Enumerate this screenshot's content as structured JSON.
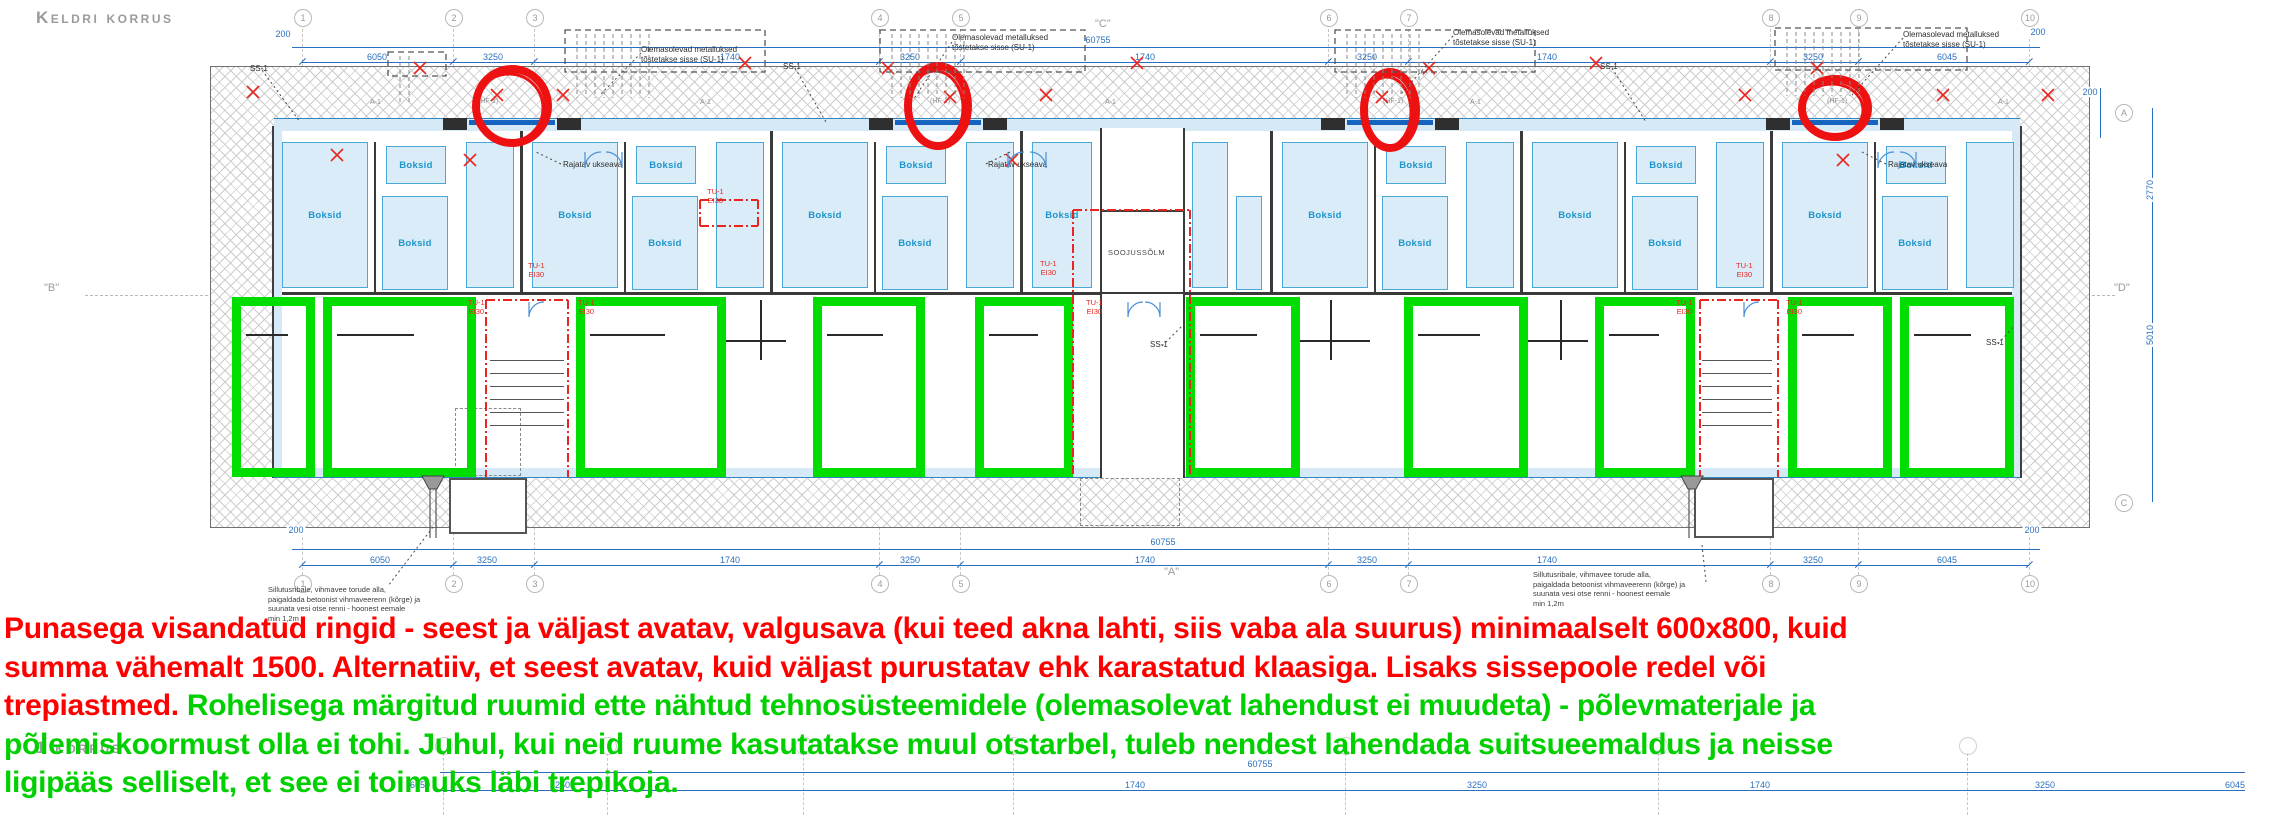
{
  "title": "Keldri korrus",
  "floor1_title": "1 korrus",
  "colors": {
    "red": "#ff0000",
    "green": "#00cf00",
    "dim_blue": "#2a6fc0",
    "boksid_fill": "#d9ecf7",
    "boksid_stroke": "#49a8d8",
    "boksid_text": "#1e95cc",
    "green_room": "#00dd00",
    "fire_red": "#e8251f",
    "wall": "#3a3a3a",
    "muted": "#9b9b9b"
  },
  "legend": {
    "lines": [
      {
        "segs": [
          {
            "c": "#ff0000",
            "t": "Punasega visandatud ringid - seest ja väljast avatav, valgusava (kui teed akna lahti, siis vaba ala suurus) minimaalselt 600x800, kuid"
          }
        ]
      },
      {
        "segs": [
          {
            "c": "#ff0000",
            "t": "summa vähemalt 1500. Alternatiiv, et seest avatav, kuid väljast purustatav ehk karastatud klaasiga. Lisaks sissepoole redel või"
          }
        ]
      },
      {
        "segs": [
          {
            "c": "#ff0000",
            "t": "trepiastmed. "
          },
          {
            "c": "#00cf00",
            "t": "Rohelisega märgitud ruumid ette nähtud tehnosüsteemidele (olemasolevat lahendust ei muudeta) - põlevmaterjale ja"
          }
        ]
      },
      {
        "segs": [
          {
            "c": "#00cf00",
            "t": "põlemiskoormust olla ei tohi. Juhul, kui neid ruume kasutatakse muul otstarbel, tuleb nendest lahendada suitsueemaldus ja neisse"
          }
        ]
      },
      {
        "segs": [
          {
            "c": "#00cf00",
            "t": "ligipääs selliselt, et see ei toimuks läbi trepikoja."
          }
        ]
      }
    ]
  },
  "plan": {
    "grid_numbers": [
      "1",
      "2",
      "3",
      "4",
      "5",
      "6",
      "7",
      "8",
      "9",
      "10"
    ],
    "grid_x": [
      302,
      453,
      534,
      879,
      960,
      1328,
      1408,
      1770,
      1858,
      2029
    ],
    "side_bubbles": [
      {
        "t": "A",
        "x": 2123,
        "y": 112
      },
      {
        "t": "C",
        "x": 2123,
        "y": 502
      }
    ],
    "section_markers": [
      {
        "t": "\"C\"",
        "x": 1095,
        "y": 18
      },
      {
        "t": "\"A\"",
        "x": 1164,
        "y": 566
      },
      {
        "t": "\"B\"",
        "x": 44,
        "y": 282
      },
      {
        "t": "\"D\"",
        "x": 2114,
        "y": 282
      }
    ],
    "dims": {
      "top_total": {
        "v": "60755",
        "x": 1098,
        "y": 40
      },
      "top_total_y": 47,
      "top_row_y": 62,
      "top": [
        [
          "6050",
          377
        ],
        [
          "3250",
          493
        ],
        [
          "1740",
          730
        ],
        [
          "3250",
          910
        ],
        [
          "1740",
          1145
        ],
        [
          "3250",
          1367
        ],
        [
          "1740",
          1547
        ],
        [
          "3250",
          1813
        ],
        [
          "6045",
          1947
        ]
      ],
      "top_200": [
        {
          "v": "200",
          "x": 283,
          "y": 34
        },
        {
          "v": "200",
          "x": 2038,
          "y": 32
        }
      ],
      "bottom_total": {
        "v": "60755",
        "x": 1163,
        "y": 542
      },
      "bottom_total_y": 549,
      "bottom_row_y": 565,
      "bottom": [
        [
          "6050",
          380
        ],
        [
          "3250",
          487
        ],
        [
          "1740",
          730
        ],
        [
          "3250",
          910
        ],
        [
          "1740",
          1145
        ],
        [
          "3250",
          1367
        ],
        [
          "1740",
          1547
        ],
        [
          "3250",
          1813
        ],
        [
          "6045",
          1947
        ]
      ],
      "bottom_200": [
        {
          "v": "200",
          "x": 296,
          "y": 530
        },
        {
          "v": "200",
          "x": 2032,
          "y": 530
        }
      ],
      "right": [
        {
          "v": "200",
          "x": 2090,
          "y": 92,
          "rot": 0
        },
        {
          "v": "2770",
          "x": 2150,
          "y": 190,
          "rot": 1
        },
        {
          "v": "5010",
          "x": 2150,
          "y": 335,
          "rot": 1
        }
      ]
    },
    "labels": {
      "boksid": "Boksid",
      "soojussolm": "SOOJUSSÕLM",
      "ss1": "SS-1",
      "su1_line1": "Olemasolevad metalluksed",
      "su1_line2": "tõstetakse sisse (SU-1)",
      "rajatav": "Rajatav ukseava",
      "fire1": "TU-1",
      "fire2": "EI30",
      "a1": "A-1",
      "hf1": "(HF-1)",
      "drain_note": [
        "Sillutusribale, vihmavee torude alla,",
        "paigaldada betoonist vihmaveerenn (kõrge) ja",
        "suunata vesi otse renni - hoonest eemale",
        "min 1,2m"
      ]
    },
    "ss1_pos": [
      [
        250,
        64
      ],
      [
        783,
        62
      ],
      [
        1600,
        62
      ],
      [
        1150,
        340
      ],
      [
        1986,
        338
      ]
    ],
    "su1_pos": [
      [
        641,
        45
      ],
      [
        952,
        33
      ],
      [
        1453,
        28
      ],
      [
        1903,
        30
      ]
    ],
    "rajatav_pos": [
      [
        563,
        160
      ],
      [
        988,
        160
      ],
      [
        1888,
        160
      ]
    ],
    "a1_pos": [
      [
        370,
        99
      ],
      [
        700,
        99
      ],
      [
        1105,
        99
      ],
      [
        1470,
        99
      ],
      [
        1998,
        99
      ]
    ],
    "hf1_pos": [
      [
        478,
        98
      ],
      [
        930,
        98
      ],
      [
        1383,
        98
      ],
      [
        1827,
        98
      ]
    ],
    "fire_pos": [
      [
        528,
        262
      ],
      [
        468,
        299
      ],
      [
        578,
        299
      ],
      [
        1040,
        260
      ],
      [
        1086,
        299
      ],
      [
        1736,
        262
      ],
      [
        1676,
        299
      ],
      [
        1786,
        299
      ],
      [
        707,
        188
      ]
    ],
    "drain_note_pos": [
      [
        268,
        585
      ],
      [
        1533,
        570
      ]
    ],
    "boksid_boxes": [
      [
        282,
        142,
        86,
        146,
        1
      ],
      [
        386,
        146,
        60,
        38,
        1
      ],
      [
        382,
        196,
        66,
        94,
        1
      ],
      [
        466,
        142,
        48,
        146,
        0
      ],
      [
        532,
        142,
        86,
        146,
        1
      ],
      [
        636,
        146,
        60,
        38,
        1
      ],
      [
        632,
        196,
        66,
        94,
        1
      ],
      [
        716,
        142,
        48,
        146,
        0
      ],
      [
        782,
        142,
        86,
        146,
        1
      ],
      [
        886,
        146,
        60,
        38,
        1
      ],
      [
        882,
        196,
        66,
        94,
        1
      ],
      [
        966,
        142,
        48,
        146,
        0
      ],
      [
        1032,
        142,
        60,
        146,
        1
      ],
      [
        1192,
        142,
        36,
        146,
        0
      ],
      [
        1236,
        196,
        26,
        94,
        0
      ],
      [
        1282,
        142,
        86,
        146,
        1
      ],
      [
        1386,
        146,
        60,
        38,
        1
      ],
      [
        1382,
        196,
        66,
        94,
        1
      ],
      [
        1466,
        142,
        48,
        146,
        0
      ],
      [
        1532,
        142,
        86,
        146,
        1
      ],
      [
        1636,
        146,
        60,
        38,
        1
      ],
      [
        1632,
        196,
        66,
        94,
        1
      ],
      [
        1716,
        142,
        48,
        146,
        0
      ],
      [
        1782,
        142,
        86,
        146,
        1
      ],
      [
        1886,
        146,
        60,
        38,
        1
      ],
      [
        1882,
        196,
        66,
        94,
        1
      ],
      [
        1966,
        142,
        48,
        146,
        0
      ]
    ],
    "green_rooms": [
      [
        232,
        297,
        83,
        180
      ],
      [
        323,
        297,
        153,
        180
      ],
      [
        576,
        297,
        150,
        180
      ],
      [
        813,
        297,
        112,
        180
      ],
      [
        975,
        297,
        98,
        180
      ],
      [
        1186,
        297,
        114,
        180
      ],
      [
        1404,
        297,
        124,
        180
      ],
      [
        1595,
        297,
        100,
        180
      ],
      [
        1788,
        297,
        104,
        180
      ],
      [
        1900,
        297,
        114,
        180
      ]
    ],
    "stairs": [
      {
        "x": 490,
        "y": 360,
        "w": 74,
        "n": 6
      },
      {
        "x": 1702,
        "y": 360,
        "w": 70,
        "n": 6
      }
    ],
    "windows_x": [
      469,
      895,
      1347,
      1792
    ],
    "lintels_x": [
      443,
      557,
      869,
      983,
      1321,
      1435,
      1766,
      1880
    ],
    "bay_walls_x": [
      520,
      770,
      1020,
      1270,
      1520,
      1770
    ],
    "inner_walls_x": [
      374,
      624,
      874,
      1374,
      1624,
      1874
    ],
    "stoops": [
      [
        449,
        478,
        78,
        56,
        0
      ],
      [
        1080,
        478,
        100,
        48,
        1
      ],
      [
        1694,
        478,
        80,
        60,
        0
      ]
    ],
    "svg": {
      "circles": [
        [
          512,
          106,
          36,
          37
        ],
        [
          938,
          106,
          30,
          40
        ],
        [
          1390,
          110,
          26,
          38
        ],
        [
          1835,
          108,
          33,
          29
        ]
      ],
      "xmarks": [
        [
          253,
          92
        ],
        [
          420,
          68
        ],
        [
          497,
          95
        ],
        [
          563,
          95
        ],
        [
          745,
          63
        ],
        [
          888,
          68
        ],
        [
          950,
          97
        ],
        [
          1046,
          95
        ],
        [
          1137,
          63
        ],
        [
          1382,
          97
        ],
        [
          1429,
          68
        ],
        [
          1596,
          63
        ],
        [
          1745,
          95
        ],
        [
          1817,
          68
        ],
        [
          1943,
          95
        ],
        [
          337,
          155
        ],
        [
          1012,
          160
        ],
        [
          1843,
          160
        ],
        [
          470,
          160
        ],
        [
          2048,
          95
        ]
      ],
      "arcs": [
        [
          585,
          152,
          16,
          1
        ],
        [
          622,
          152,
          16,
          0
        ],
        [
          1008,
          152,
          16,
          1
        ],
        [
          1046,
          152,
          16,
          0
        ],
        [
          1878,
          152,
          16,
          1
        ],
        [
          1916,
          152,
          16,
          0
        ],
        [
          529,
          302,
          15,
          1
        ],
        [
          1128,
          302,
          15,
          1
        ],
        [
          1160,
          302,
          15,
          0
        ],
        [
          1744,
          302,
          15,
          1
        ]
      ],
      "dashdot": [
        [
          486,
          300,
          486,
          477
        ],
        [
          568,
          300,
          568,
          477
        ],
        [
          1073,
          210,
          1073,
          477
        ],
        [
          1190,
          210,
          1190,
          477
        ],
        [
          1700,
          300,
          1700,
          477
        ],
        [
          1778,
          300,
          1778,
          477
        ],
        [
          486,
          300,
          568,
          300
        ],
        [
          1700,
          300,
          1778,
          300
        ],
        [
          1073,
          210,
          1190,
          210
        ],
        [
          700,
          200,
          758,
          200
        ],
        [
          700,
          226,
          758,
          226
        ],
        [
          700,
          200,
          700,
          226
        ],
        [
          758,
          200,
          758,
          226
        ]
      ],
      "leaders": [
        [
          262,
          70,
          300,
          122
        ],
        [
          795,
          68,
          826,
          122
        ],
        [
          1612,
          68,
          1646,
          122
        ],
        [
          1162,
          346,
          1186,
          322
        ],
        [
          1998,
          344,
          2014,
          326
        ],
        [
          641,
          53,
          600,
          95
        ],
        [
          952,
          42,
          913,
          100
        ],
        [
          1453,
          36,
          1400,
          95
        ],
        [
          1903,
          38,
          1852,
          95
        ],
        [
          561,
          164,
          536,
          152
        ],
        [
          986,
          164,
          1010,
          152
        ],
        [
          1886,
          164,
          1862,
          152
        ],
        [
          433,
          527,
          388,
          586
        ],
        [
          1702,
          545,
          1706,
          582
        ]
      ],
      "combs": [
        [
          565,
          30,
          200,
          42
        ],
        [
          880,
          30,
          205,
          42
        ],
        [
          1335,
          30,
          200,
          42
        ],
        [
          1775,
          28,
          192,
          42
        ],
        [
          388,
          52,
          58,
          24
        ]
      ],
      "drains": [
        [
          433,
          476
        ],
        [
          1692,
          476
        ]
      ]
    },
    "fragment": {
      "bubble_x": [
        443,
        607,
        803,
        1013,
        1345,
        1658,
        1967
      ],
      "bubble_y": 745,
      "line1_y": 772,
      "line2_y": 790,
      "total": {
        "v": "60755",
        "x": 1260,
        "y": 764
      },
      "dims": [
        [
          "6050",
          420
        ],
        [
          "3250",
          560
        ],
        [
          "1740",
          1135
        ],
        [
          "3250",
          1477
        ],
        [
          "1740",
          1760
        ],
        [
          "3250",
          2045
        ],
        [
          "6045",
          2235
        ]
      ]
    }
  }
}
